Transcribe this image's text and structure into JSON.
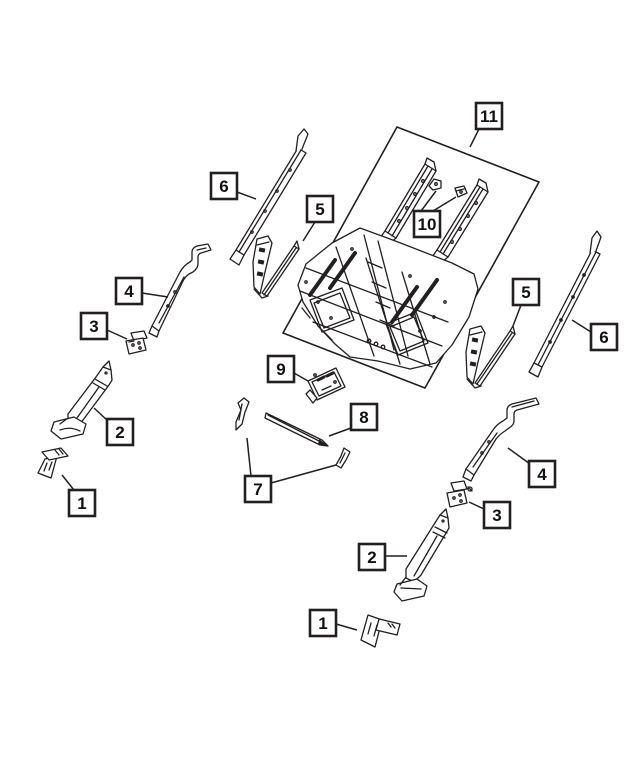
{
  "diagram": {
    "kind": "exploded-parts-line-diagram",
    "background": "#ffffff",
    "line_color": "#231f20"
  },
  "callouts": [
    {
      "id": "11",
      "label": "11"
    },
    {
      "id": "10",
      "label": "10"
    },
    {
      "id": "6-left",
      "label": "6"
    },
    {
      "id": "5-left",
      "label": "5"
    },
    {
      "id": "4-left",
      "label": "4"
    },
    {
      "id": "3-left",
      "label": "3"
    },
    {
      "id": "2-left",
      "label": "2"
    },
    {
      "id": "1-left",
      "label": "1"
    },
    {
      "id": "9",
      "label": "9"
    },
    {
      "id": "8",
      "label": "8"
    },
    {
      "id": "7",
      "label": "7"
    },
    {
      "id": "5-right",
      "label": "5"
    },
    {
      "id": "6-right",
      "label": "6"
    },
    {
      "id": "4-right",
      "label": "4"
    },
    {
      "id": "3-right",
      "label": "3"
    },
    {
      "id": "2-right",
      "label": "2"
    },
    {
      "id": "1-right",
      "label": "1"
    }
  ]
}
